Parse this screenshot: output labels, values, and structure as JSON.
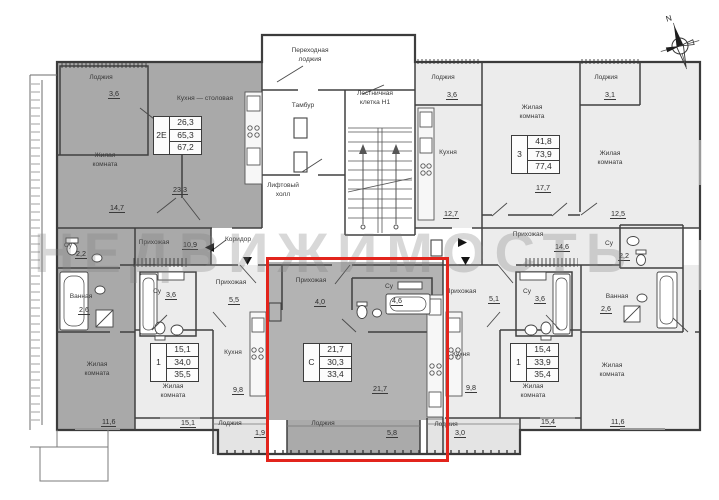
{
  "watermark": "НЕДВИЖИМОСТЬ",
  "compass_label": "N",
  "highlight_color": "#e2241c",
  "apartment_tables": [
    {
      "n": "apartment-2e",
      "type": "2Е",
      "values": [
        "26,3",
        "65,3",
        "67,2"
      ],
      "x": 153,
      "y": 116
    },
    {
      "n": "apartment-3",
      "type": "3",
      "values": [
        "41,8",
        "73,9",
        "77,4"
      ],
      "x": 511,
      "y": 135
    },
    {
      "n": "apartment-1-left",
      "type": "1",
      "values": [
        "15,1",
        "34,0",
        "35,5"
      ],
      "x": 150,
      "y": 343
    },
    {
      "n": "apartment-studio",
      "type": "С",
      "values": [
        "21,7",
        "30,3",
        "33,4"
      ],
      "x": 303,
      "y": 343
    },
    {
      "n": "apartment-1-right",
      "type": "1",
      "values": [
        "15,4",
        "33,9",
        "35,4"
      ],
      "x": 510,
      "y": 343
    }
  ],
  "labels": [
    {
      "n": "loggia-2e",
      "t": "Лоджия",
      "x": 78,
      "y": 74,
      "w": 46,
      "c": "r"
    },
    {
      "n": "loggia-2e-area",
      "t": "3,6",
      "x": 108,
      "y": 89,
      "c": "a"
    },
    {
      "n": "kitchen-dining-2e",
      "t": "Кухня — столовая",
      "x": 155,
      "y": 95,
      "w": 100,
      "c": "r"
    },
    {
      "n": "kitchen-dining-2e-area",
      "t": "23,3",
      "x": 172,
      "y": 185,
      "c": "a"
    },
    {
      "n": "living-2e-1",
      "t": "Жилая\nкомната",
      "x": 78,
      "y": 152,
      "w": 54,
      "c": "r"
    },
    {
      "n": "living-2e-1-area",
      "t": "14,7",
      "x": 109,
      "y": 203,
      "c": "a"
    },
    {
      "n": "wc-2e",
      "t": "Су",
      "x": 60,
      "y": 242,
      "w": 16,
      "c": "r"
    },
    {
      "n": "wc-2e-area",
      "t": "2,2",
      "x": 75,
      "y": 249,
      "c": "a"
    },
    {
      "n": "bath-2e",
      "t": "Ванная",
      "x": 60,
      "y": 293,
      "w": 42,
      "c": "r"
    },
    {
      "n": "bath-2e-area",
      "t": "2,6",
      "x": 78,
      "y": 305,
      "c": "a"
    },
    {
      "n": "hall-2e",
      "t": "Прихожая",
      "x": 128,
      "y": 239,
      "w": 52,
      "c": "r"
    },
    {
      "n": "hall-2e-area",
      "t": "10,9",
      "x": 182,
      "y": 240,
      "c": "a"
    },
    {
      "n": "living-2e-2",
      "t": "Жилая\nкомната",
      "x": 70,
      "y": 361,
      "w": 54,
      "c": "r"
    },
    {
      "n": "living-2e-2-area",
      "t": "11,6",
      "x": 101,
      "y": 417,
      "c": "a"
    },
    {
      "n": "transfer-loggia",
      "t": "Переходная\nлоджия",
      "x": 272,
      "y": 47,
      "w": 76,
      "c": "r"
    },
    {
      "n": "tambour",
      "t": "Тамбур",
      "x": 281,
      "y": 102,
      "w": 44,
      "c": "r"
    },
    {
      "n": "stairwell",
      "t": "Лестничная\nклетка Н1",
      "x": 338,
      "y": 90,
      "w": 74,
      "c": "r"
    },
    {
      "n": "elevator-hall",
      "t": "Лифтовый\nхолл",
      "x": 252,
      "y": 182,
      "w": 62,
      "c": "r"
    },
    {
      "n": "corridor",
      "t": "Коридор",
      "x": 214,
      "y": 236,
      "w": 48,
      "c": "r"
    },
    {
      "n": "loggia-3-left",
      "t": "Лоджия",
      "x": 422,
      "y": 74,
      "w": 42,
      "c": "r"
    },
    {
      "n": "loggia-3-left-area",
      "t": "3,6",
      "x": 446,
      "y": 90,
      "c": "a"
    },
    {
      "n": "kitchen-3",
      "t": "Кухня",
      "x": 430,
      "y": 149,
      "w": 36,
      "c": "r"
    },
    {
      "n": "kitchen-3-area",
      "t": "12,7",
      "x": 443,
      "y": 209,
      "c": "a"
    },
    {
      "n": "living-3-1",
      "t": "Жилая\nкомната",
      "x": 505,
      "y": 104,
      "w": 54,
      "c": "r"
    },
    {
      "n": "living-3-1-area",
      "t": "17,7",
      "x": 535,
      "y": 183,
      "c": "a"
    },
    {
      "n": "loggia-3-right",
      "t": "Лоджия",
      "x": 585,
      "y": 74,
      "w": 42,
      "c": "r"
    },
    {
      "n": "loggia-3-right-area",
      "t": "3,1",
      "x": 604,
      "y": 90,
      "c": "a"
    },
    {
      "n": "living-3-2",
      "t": "Жилая\nкомната",
      "x": 582,
      "y": 150,
      "w": 56,
      "c": "r"
    },
    {
      "n": "living-3-2-area",
      "t": "12,5",
      "x": 610,
      "y": 209,
      "c": "a"
    },
    {
      "n": "hall-3",
      "t": "Прихожая",
      "x": 502,
      "y": 231,
      "w": 52,
      "c": "r"
    },
    {
      "n": "hall-3-area",
      "t": "14,6",
      "x": 554,
      "y": 242,
      "c": "a"
    },
    {
      "n": "wc-3",
      "t": "Су",
      "x": 602,
      "y": 240,
      "w": 14,
      "c": "r"
    },
    {
      "n": "wc-3-area",
      "t": "2,2",
      "x": 618,
      "y": 251,
      "c": "a"
    },
    {
      "n": "bath-3",
      "t": "Ванная",
      "x": 596,
      "y": 293,
      "w": 42,
      "c": "r"
    },
    {
      "n": "bath-3-area",
      "t": "2,6",
      "x": 600,
      "y": 304,
      "c": "a"
    },
    {
      "n": "living-3-3",
      "t": "Жилая\nкомната",
      "x": 584,
      "y": 362,
      "w": 56,
      "c": "r"
    },
    {
      "n": "living-3-3-area",
      "t": "11,6",
      "x": 610,
      "y": 417,
      "c": "a"
    },
    {
      "n": "hall-1-left",
      "t": "Прихожая",
      "x": 205,
      "y": 279,
      "w": 52,
      "c": "r"
    },
    {
      "n": "hall-1-left-area",
      "t": "5,5",
      "x": 228,
      "y": 295,
      "c": "a"
    },
    {
      "n": "wc-1-left",
      "t": "Су",
      "x": 150,
      "y": 288,
      "w": 14,
      "c": "r"
    },
    {
      "n": "wc-1-left-area",
      "t": "3,6",
      "x": 165,
      "y": 290,
      "c": "a"
    },
    {
      "n": "kitchen-1-left",
      "t": "Кухня",
      "x": 216,
      "y": 349,
      "w": 34,
      "c": "r"
    },
    {
      "n": "kitchen-1-left-area",
      "t": "9,8",
      "x": 232,
      "y": 385,
      "c": "a"
    },
    {
      "n": "living-1-left",
      "t": "Жилая\nкомната",
      "x": 146,
      "y": 383,
      "w": 54,
      "c": "r"
    },
    {
      "n": "living-1-left-area",
      "t": "15,1",
      "x": 180,
      "y": 418,
      "c": "a"
    },
    {
      "n": "loggia-1-left",
      "t": "Лоджия",
      "x": 210,
      "y": 420,
      "w": 40,
      "c": "r"
    },
    {
      "n": "loggia-1-left-area",
      "t": "1,9",
      "x": 254,
      "y": 428,
      "c": "a"
    },
    {
      "n": "hall-studio",
      "t": "Прихожая",
      "x": 284,
      "y": 277,
      "w": 54,
      "c": "r"
    },
    {
      "n": "hall-studio-area",
      "t": "4,0",
      "x": 314,
      "y": 297,
      "c": "a"
    },
    {
      "n": "wc-studio",
      "t": "Су",
      "x": 382,
      "y": 283,
      "w": 14,
      "c": "r"
    },
    {
      "n": "wc-studio-area",
      "t": "4,6",
      "x": 391,
      "y": 296,
      "c": "a"
    },
    {
      "n": "living-studio-area",
      "t": "21,7",
      "x": 372,
      "y": 384,
      "c": "a"
    },
    {
      "n": "loggia-studio",
      "t": "Лоджия",
      "x": 302,
      "y": 420,
      "w": 42,
      "c": "r"
    },
    {
      "n": "loggia-studio-area",
      "t": "5,8",
      "x": 386,
      "y": 428,
      "c": "a"
    },
    {
      "n": "hall-1-right",
      "t": "Прихожая",
      "x": 435,
      "y": 288,
      "w": 52,
      "c": "r"
    },
    {
      "n": "hall-1-right-area",
      "t": "5,1",
      "x": 488,
      "y": 294,
      "c": "a"
    },
    {
      "n": "wc-1-right",
      "t": "Су",
      "x": 520,
      "y": 288,
      "w": 14,
      "c": "r"
    },
    {
      "n": "wc-1-right-area",
      "t": "3,6",
      "x": 534,
      "y": 294,
      "c": "a"
    },
    {
      "n": "kitchen-1-right",
      "t": "Кухня",
      "x": 444,
      "y": 351,
      "w": 34,
      "c": "r"
    },
    {
      "n": "kitchen-1-right-area",
      "t": "9,8",
      "x": 465,
      "y": 383,
      "c": "a"
    },
    {
      "n": "living-1-right",
      "t": "Жилая\nкомната",
      "x": 506,
      "y": 383,
      "w": 54,
      "c": "r"
    },
    {
      "n": "living-1-right-area",
      "t": "15,4",
      "x": 540,
      "y": 417,
      "c": "a"
    },
    {
      "n": "loggia-1-right",
      "t": "Лоджия",
      "x": 426,
      "y": 421,
      "w": 40,
      "c": "r"
    },
    {
      "n": "loggia-1-right-area",
      "t": "3,0",
      "x": 454,
      "y": 428,
      "c": "a"
    }
  ]
}
